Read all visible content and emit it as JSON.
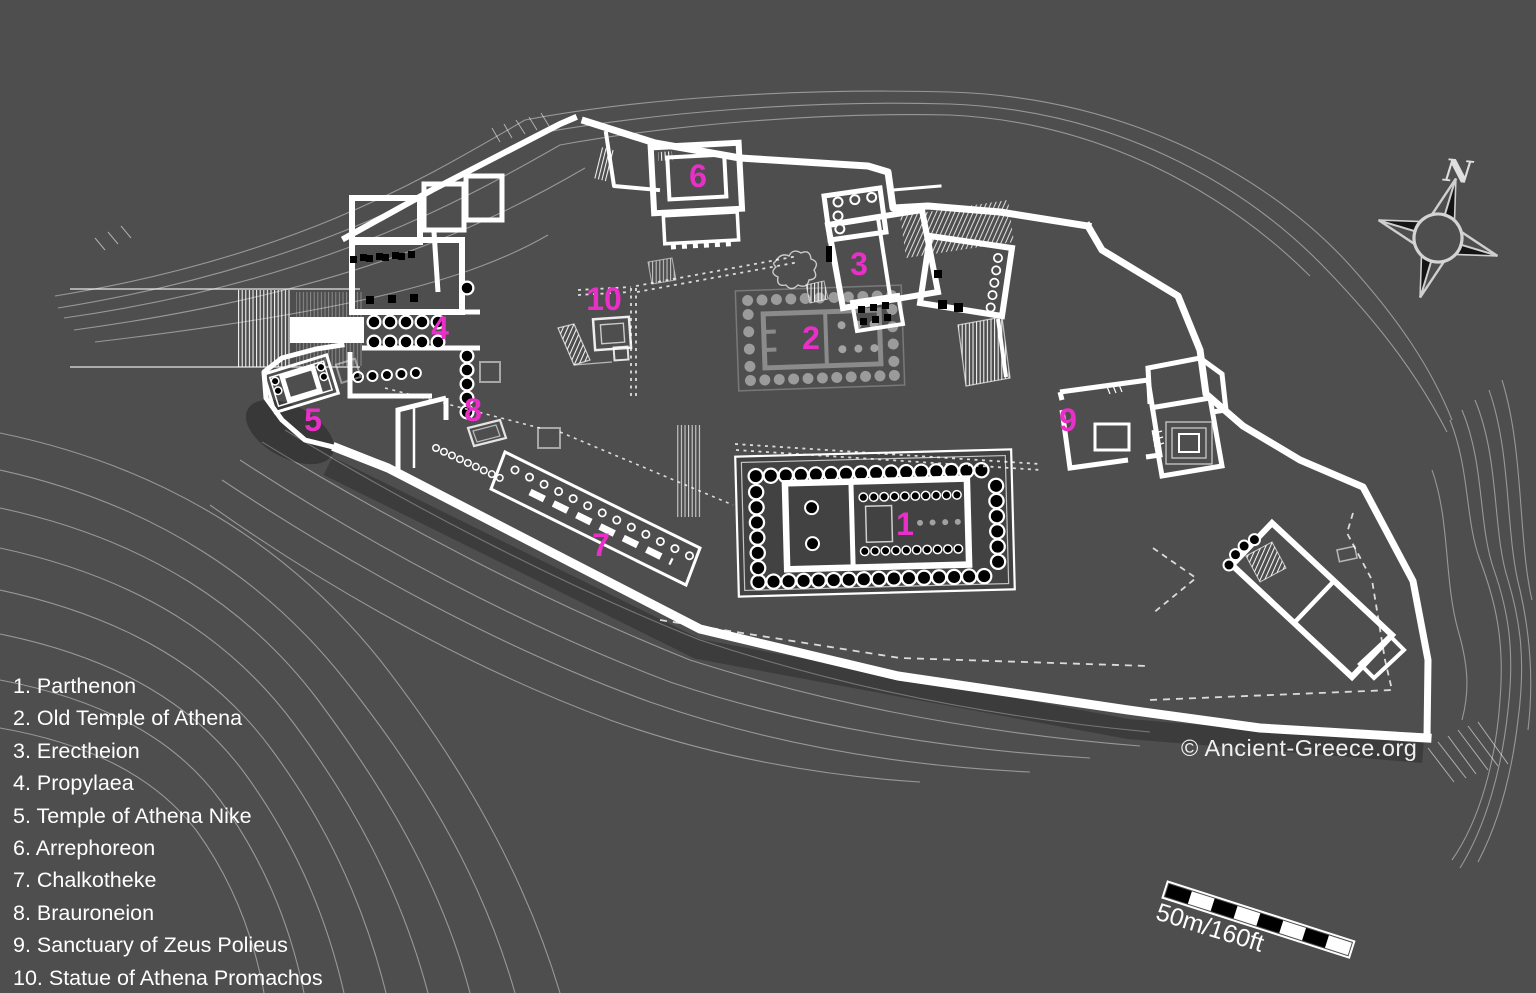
{
  "page": {
    "background": "#4e4e4e",
    "description_map": "Plan of the Acropolis of Athens"
  },
  "legend": {
    "items": [
      "1. Parthenon",
      "2. Old Temple of Athena",
      "3. Erectheion",
      "4. Propylaea",
      "5. Temple of Athena Nike",
      "6. Arrephoreon",
      "7. Chalkotheke",
      "8. Brauroneion",
      "9. Sanctuary of Zeus Polieus",
      "10. Statue of Athena Promachos"
    ]
  },
  "markers": [
    {
      "number": "1",
      "building": "Parthenon",
      "x": 905,
      "y": 524
    },
    {
      "number": "2",
      "building": "Old Temple of Athena",
      "x": 811,
      "y": 338
    },
    {
      "number": "3",
      "building": "Erectheion",
      "x": 859,
      "y": 264
    },
    {
      "number": "4",
      "building": "Propylaea",
      "x": 440,
      "y": 328
    },
    {
      "number": "5",
      "building": "Temple of Athena Nike",
      "x": 313,
      "y": 420
    },
    {
      "number": "6",
      "building": "Arrephoreon",
      "x": 698,
      "y": 176
    },
    {
      "number": "7",
      "building": "Chalkotheke",
      "x": 601,
      "y": 545
    },
    {
      "number": "8",
      "building": "Brauroneion",
      "x": 473,
      "y": 410
    },
    {
      "number": "9",
      "building": "Sanctuary of Zeus Polieus",
      "x": 1068,
      "y": 420
    },
    {
      "number": "10",
      "building": "Statue of Athena Promachos",
      "x": 604,
      "y": 299
    }
  ],
  "compass": {
    "north_label": "N"
  },
  "scale_bar": {
    "label": "50m/160ft"
  },
  "credit": "© Ancient-Greece.org",
  "colors": {
    "background": "#4e4e4e",
    "plan_line": "#ffffff",
    "ghost_line": "#9b9b9b",
    "marker_text": "#ea2fc8",
    "legend_text": "#ffffff"
  }
}
